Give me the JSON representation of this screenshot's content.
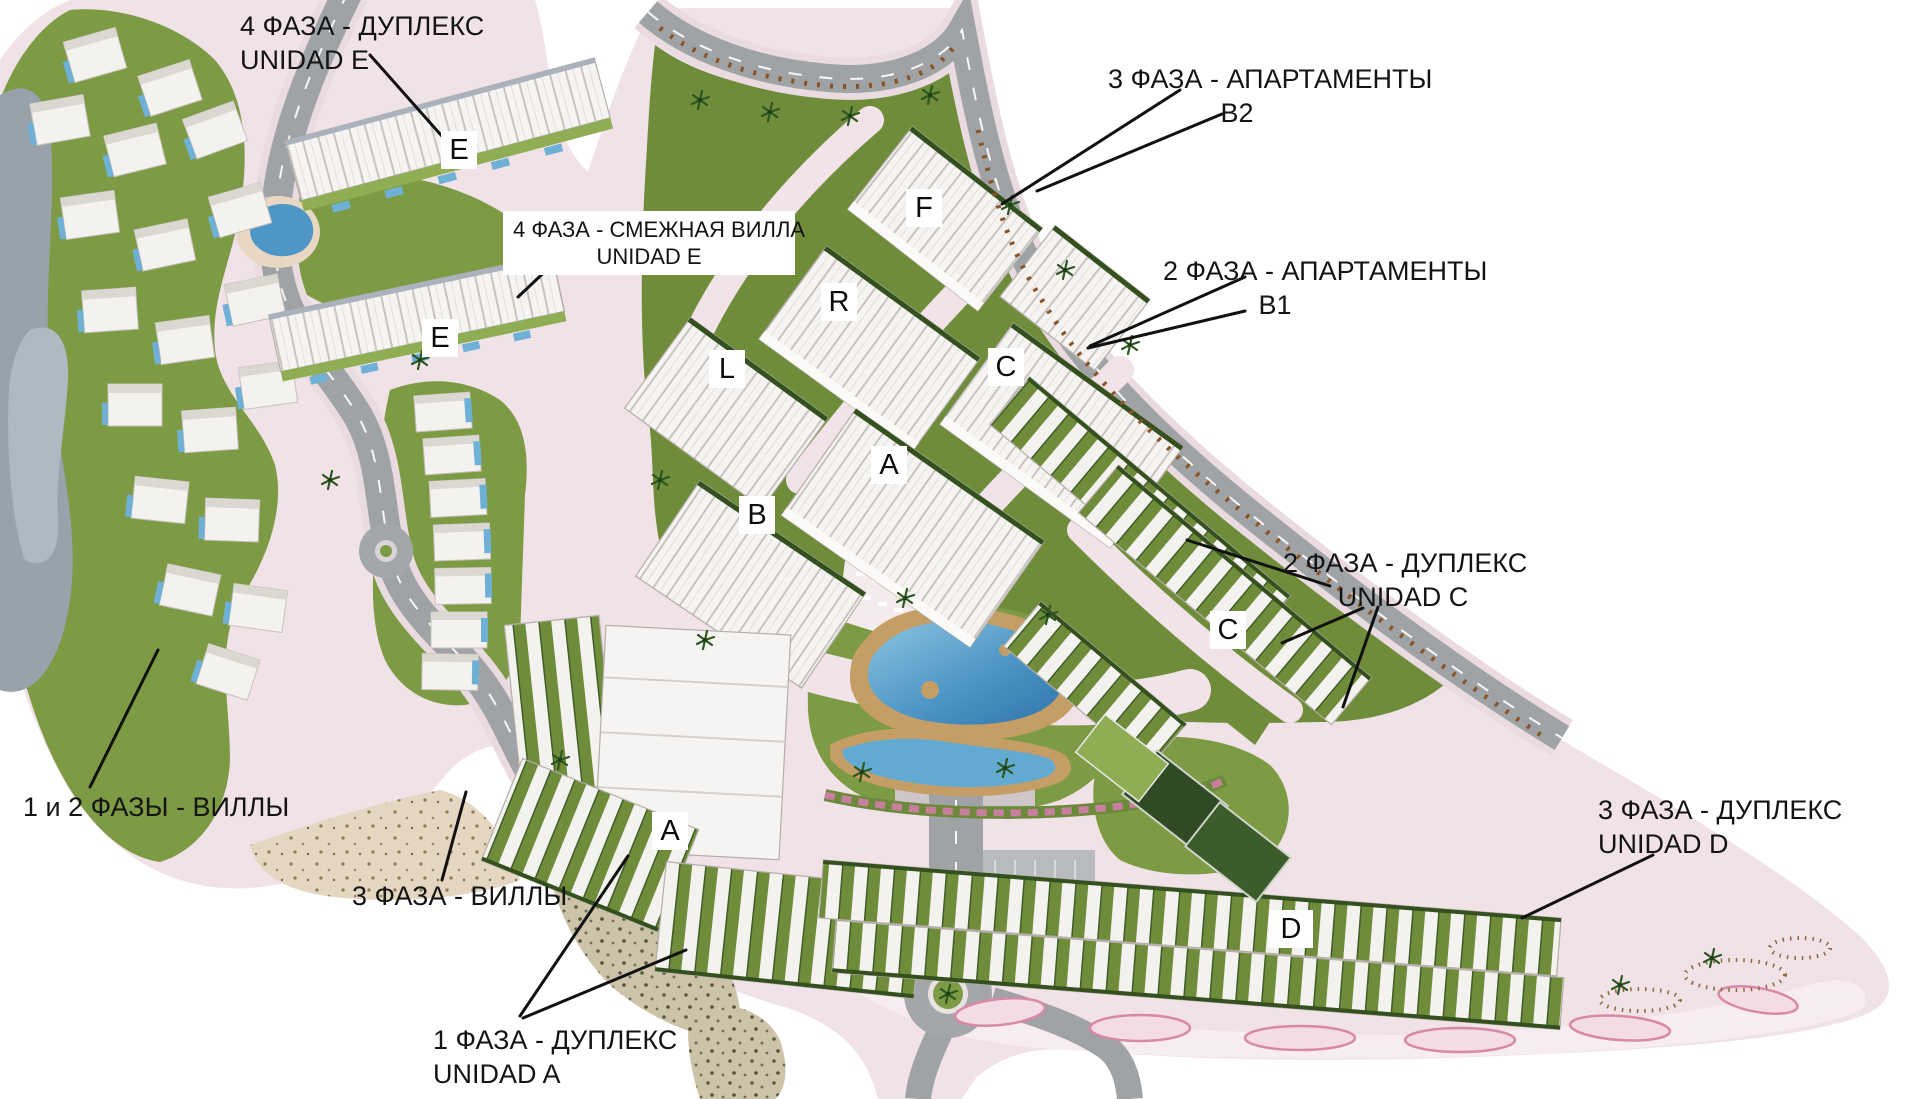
{
  "annotations": {
    "phase4_duplex_e": {
      "line1": "4 ФАЗА - ДУПЛЕКС",
      "line2": "UNIDAD E"
    },
    "phase3_apartments_b2": {
      "line1": "3 ФАЗА - АПАРТАМЕНТЫ",
      "line2": "В2"
    },
    "phase4_adjoining_villa_e": {
      "line1": "4 ФАЗА - СМЕЖНАЯ ВИЛЛА",
      "line2": "UNIDAD E"
    },
    "phase2_apartments_b1": {
      "line1": "2 ФАЗА - АПАРТАМЕНТЫ",
      "line2": "В1"
    },
    "phase2_duplex_c": {
      "line1": "2 ФАЗА - ДУПЛЕКС",
      "line2": "UNIDAD C"
    },
    "phase3_duplex_d": {
      "line1": "3 ФАЗА - ДУПЛЕКС",
      "line2": "UNIDAD D"
    },
    "phase12_villas": {
      "line1": "1 и 2 ФАЗЫ - ВИЛЛЫ"
    },
    "phase3_villas": {
      "line1": "3 ФАЗА - ВИЛЛЫ"
    },
    "phase1_duplex_a": {
      "line1": "1 ФАЗА - ДУПЛЕКС",
      "line2": "UNIDAD A"
    }
  },
  "building_markers": {
    "e_upper": "E",
    "e_lower": "E",
    "f": "F",
    "r": "R",
    "l": "L",
    "c_upper": "C",
    "a_central": "A",
    "b": "B",
    "c_duplex": "C",
    "a_duplex": "A",
    "d": "D"
  },
  "colors": {
    "site_pink": "#f1e2e7",
    "road_gray": "#9fa3a6",
    "grass_green": "#7d9a45",
    "hedge_green": "#33501e",
    "pool_blue": "#4e96c6",
    "deck_tan": "#c59e66",
    "building_white": "#f6f4f2",
    "annotation_text": "#141414",
    "marker_background": "#ffffff"
  }
}
